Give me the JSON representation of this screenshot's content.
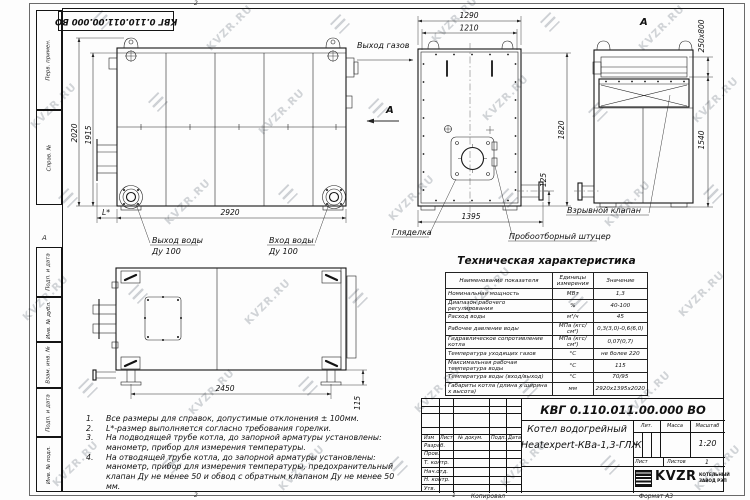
{
  "watermark": {
    "text": "KVZR.RU"
  },
  "frame": {
    "top_stamp": "КВГ 0.110.011.00.000 ВО",
    "margin_labels": [
      "Перв. примен.",
      "Справ. №",
      "Подп. и дата",
      "Инв. № дубл.",
      "Взам. инв. №",
      "Подп. и дата",
      "Инв. № подл."
    ],
    "zone_letter": "А",
    "zone_top": "2",
    "zone_bottom_left": "2",
    "zone_bottom_right": "1"
  },
  "views": {
    "side": {
      "dim_height_outer": "2020",
      "dim_height_inner": "1915",
      "dim_length": "2920",
      "dim_l": "L*",
      "label_gas_out": "Выход газов",
      "view_arrow_letter": "А",
      "label_water_out": "Выход воды",
      "label_water_out_dn": "Ду 100",
      "label_water_in": "Вход воды",
      "label_water_in_dn": "Ду 100"
    },
    "front": {
      "dim_width_outer": "1290",
      "dim_width_inner": "1210",
      "dim_height": "1820",
      "dim_pipe": "125",
      "dim_bottom": "1395",
      "label_sight": "Гляделка",
      "label_sampling": "Пробоотборный штуцер"
    },
    "rear": {
      "view_title": "А",
      "dim_chimney": "250x800",
      "dim_height": "1540",
      "label_valve": "Взрывной клапан"
    },
    "plan": {
      "dim_length": "2450",
      "dim_foot": "115"
    }
  },
  "tech_table": {
    "title": "Техническая характеристика",
    "headers": [
      "Наименование показателя",
      "Единицы измерения",
      "Значение"
    ],
    "rows": [
      {
        "name": "Номинальная мощность",
        "unit": "МВт",
        "value": "1,3"
      },
      {
        "name": "Диапазон рабочего регулирования",
        "unit": "%",
        "value": "40-100"
      },
      {
        "name": "Расход воды",
        "unit": "м³/ч",
        "value": "45"
      },
      {
        "name": "Рабочее давление воды",
        "unit": "МПа (кгс/см²)",
        "value": "0,3(3,0)-0,6(6,0)"
      },
      {
        "name": "Гидравлическое сопротивление котла",
        "unit": "МПа (кгс/см²)",
        "value": "0,07(0,7)"
      },
      {
        "name": "Температура уходящих газов",
        "unit": "°С",
        "value": "не более 220"
      },
      {
        "name": "Максимальная рабочая температура воды",
        "unit": "°С",
        "value": "115"
      },
      {
        "name": "Температура воды (вход/выход)",
        "unit": "°С",
        "value": "70/95"
      },
      {
        "name": "Габариты котла (длина х ширина х высота)",
        "unit": "мм",
        "value": "2920х1395х2020"
      }
    ]
  },
  "notes": [
    {
      "n": "1.",
      "text": "Все размеры для справок, допустимые отклонения ± 100мм."
    },
    {
      "n": "2.",
      "text": "L*-размер выполняется согласно требования горелки."
    },
    {
      "n": "3.",
      "text": "На подводящей трубе котла, до запорной арматуры установлены: манометр, прибор для измерения температуры."
    },
    {
      "n": "4.",
      "text": "На отводящей трубе котла, до запорной арматуры установлены: манометр, прибор для измерения температуры, предохранительный клапан Ду не менее 50 и обвод с обратным клапаном Ду не менее 50 мм."
    }
  ],
  "title_block": {
    "doc_number": "КВГ 0.110.011.00.000 ВО",
    "product_name_line1": "Котел водогрейный",
    "product_name_line2": "Heatexpert-КВа-1,3-ГЛЖ",
    "col_headers": [
      "Изм",
      "Лист",
      "№ докум.",
      "Подп.",
      "Дата"
    ],
    "row_labels": [
      "Разраб.",
      "Пров.",
      "Т. контр.",
      "Нач.отд.",
      "Н. контр.",
      "Утв."
    ],
    "lit_label": "Лит.",
    "mass_label": "Масса",
    "scale_label": "Масштаб",
    "scale_value": "1:20",
    "sheet_label": "Лист",
    "sheets_label": "Листов",
    "sheets_value": "1",
    "logo_text": "KVZR",
    "logo_sub1": "КОТЕЛЬНЫЙ",
    "logo_sub2": "ЗАВОД РЭП",
    "copied": "Копировал",
    "format": "Формат А3"
  }
}
